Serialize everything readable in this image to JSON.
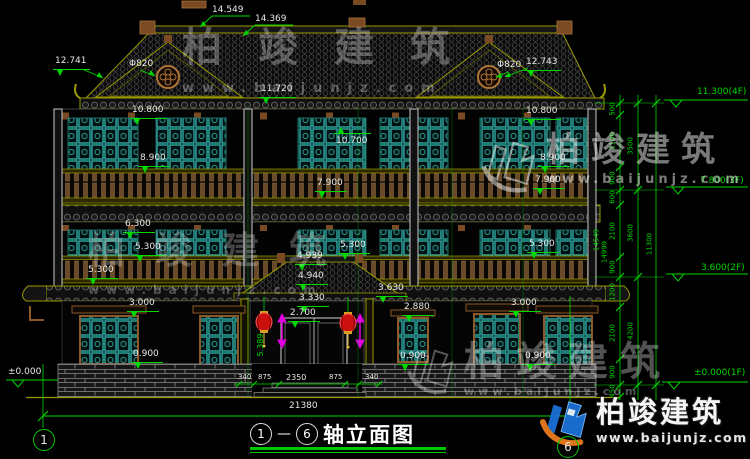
{
  "branding": {
    "name": "柏竣建筑",
    "url": "www.baijunjz.com"
  },
  "title": {
    "axis_start": "1",
    "axis_sep": "—",
    "axis_end": "6",
    "text": "轴立面图"
  },
  "axes": {
    "left_bubble": "1",
    "right_bubble": "6"
  },
  "colors": {
    "background": "#000000",
    "dim_green": "#00d800",
    "text_white": "#e8e8e8",
    "lattice_teal": "#2fa8a0",
    "outline_olive": "#9a9a00",
    "wood_brown": "#8a5a2a",
    "lantern_red": "#cc1010",
    "arrow_magenta": "#e000e0",
    "logo_blue": "#1a6fd4",
    "logo_orange": "#e87a1e"
  },
  "annotations": [
    {
      "t": "14.549",
      "x": 212,
      "y": 6
    },
    {
      "t": "14.369",
      "x": 255,
      "y": 15
    },
    {
      "t": "12.741",
      "x": 55,
      "y": 57,
      "mk": "d"
    },
    {
      "t": "Φ820",
      "x": 129,
      "y": 60
    },
    {
      "t": "Φ820",
      "x": 497,
      "y": 61
    },
    {
      "t": "12.743",
      "x": 526,
      "y": 58,
      "mk": "d"
    },
    {
      "t": "11.720",
      "x": 261,
      "y": 85,
      "mk": "d"
    },
    {
      "t": "10.800",
      "x": 132,
      "y": 106,
      "mk": "d"
    },
    {
      "t": "10.800",
      "x": 526,
      "y": 107,
      "mk": "d"
    },
    {
      "t": "10.700",
      "x": 336,
      "y": 137,
      "mk": "u"
    },
    {
      "t": "8.900",
      "x": 140,
      "y": 154,
      "mk": "d"
    },
    {
      "t": "8.900",
      "x": 540,
      "y": 154,
      "mk": "d"
    },
    {
      "t": "7.900",
      "x": 317,
      "y": 179,
      "mk": "d"
    },
    {
      "t": "7.900",
      "x": 535,
      "y": 176,
      "mk": "d"
    },
    {
      "t": "6.300",
      "x": 125,
      "y": 220,
      "mk": "d"
    },
    {
      "t": "5.300",
      "x": 135,
      "y": 243,
      "mk": "d"
    },
    {
      "t": "5.300",
      "x": 340,
      "y": 241,
      "mk": "d"
    },
    {
      "t": "5.300",
      "x": 529,
      "y": 240,
      "mk": "d"
    },
    {
      "t": "5.300",
      "x": 88,
      "y": 266,
      "mk": "d"
    },
    {
      "t": "4.939",
      "x": 297,
      "y": 252,
      "mk": "d"
    },
    {
      "t": "4.940",
      "x": 298,
      "y": 272,
      "mk": "d"
    },
    {
      "t": "3.630",
      "x": 378,
      "y": 284,
      "mk": "d"
    },
    {
      "t": "3.330",
      "x": 299,
      "y": 294,
      "mk": "d"
    },
    {
      "t": "3.000",
      "x": 129,
      "y": 299,
      "mk": "d"
    },
    {
      "t": "3.000",
      "x": 511,
      "y": 299,
      "mk": "d"
    },
    {
      "t": "2.880",
      "x": 404,
      "y": 303,
      "mk": "d"
    },
    {
      "t": "2.700",
      "x": 290,
      "y": 309,
      "mk": "d"
    },
    {
      "t": "0.900",
      "x": 133,
      "y": 350,
      "mk": "d"
    },
    {
      "t": "0.900",
      "x": 400,
      "y": 352,
      "mk": "d"
    },
    {
      "t": "0.900",
      "x": 525,
      "y": 352,
      "mk": "d"
    },
    {
      "t": "±0.000",
      "x": 8,
      "y": 368
    },
    {
      "t": "340",
      "x": 238,
      "y": 374,
      "s": 7
    },
    {
      "t": "875",
      "x": 258,
      "y": 374,
      "s": 7
    },
    {
      "t": "2350",
      "x": 286,
      "y": 374,
      "s": 8
    },
    {
      "t": "875",
      "x": 329,
      "y": 374,
      "s": 7
    },
    {
      "t": "340",
      "x": 365,
      "y": 374,
      "s": 7
    },
    {
      "t": "21380",
      "x": 289,
      "y": 402
    },
    {
      "t": "11.300(4F)",
      "x": 697,
      "y": 88,
      "g": 1
    },
    {
      "t": "7.800(3F)",
      "x": 700,
      "y": 177,
      "g": 1
    },
    {
      "t": "3.600(2F)",
      "x": 701,
      "y": 264,
      "g": 1
    },
    {
      "t": "±0.000(1F)",
      "x": 694,
      "y": 369,
      "g": 1
    },
    {
      "t": "5.389",
      "x": 261,
      "y": 345,
      "g": 1,
      "r": 1,
      "s": 8
    },
    {
      "t": "500",
      "x": 613,
      "y": 109,
      "g": 1,
      "r": 1,
      "s": 7
    },
    {
      "t": "2100",
      "x": 613,
      "y": 141,
      "g": 1,
      "r": 1,
      "s": 7
    },
    {
      "t": "900",
      "x": 613,
      "y": 178,
      "g": 1,
      "r": 1,
      "s": 7
    },
    {
      "t": "600",
      "x": 613,
      "y": 197,
      "g": 1,
      "r": 1,
      "s": 7
    },
    {
      "t": "2100",
      "x": 613,
      "y": 231,
      "g": 1,
      "r": 1,
      "s": 7
    },
    {
      "t": "900",
      "x": 613,
      "y": 267,
      "g": 1,
      "r": 1,
      "s": 7
    },
    {
      "t": "1200",
      "x": 613,
      "y": 292,
      "g": 1,
      "r": 1,
      "s": 7
    },
    {
      "t": "2100",
      "x": 613,
      "y": 333,
      "g": 1,
      "r": 1,
      "s": 7
    },
    {
      "t": "900",
      "x": 613,
      "y": 372,
      "g": 1,
      "r": 1,
      "s": 7
    },
    {
      "t": "450",
      "x": 613,
      "y": 391,
      "g": 1,
      "r": 1,
      "s": 7
    },
    {
      "t": "3500",
      "x": 631,
      "y": 146,
      "g": 1,
      "r": 1,
      "s": 7
    },
    {
      "t": "3600",
      "x": 631,
      "y": 233,
      "g": 1,
      "r": 1,
      "s": 7
    },
    {
      "t": "4200",
      "x": 631,
      "y": 331,
      "g": 1,
      "r": 1,
      "s": 7
    },
    {
      "t": "11300",
      "x": 650,
      "y": 244,
      "g": 1,
      "r": 1,
      "s": 7
    },
    {
      "t": "14549",
      "x": 597,
      "y": 240,
      "g": 1,
      "r": 1,
      "s": 7
    },
    {
      "t": "14999",
      "x": 605,
      "y": 252,
      "g": 1,
      "r": 1,
      "s": 7
    }
  ]
}
